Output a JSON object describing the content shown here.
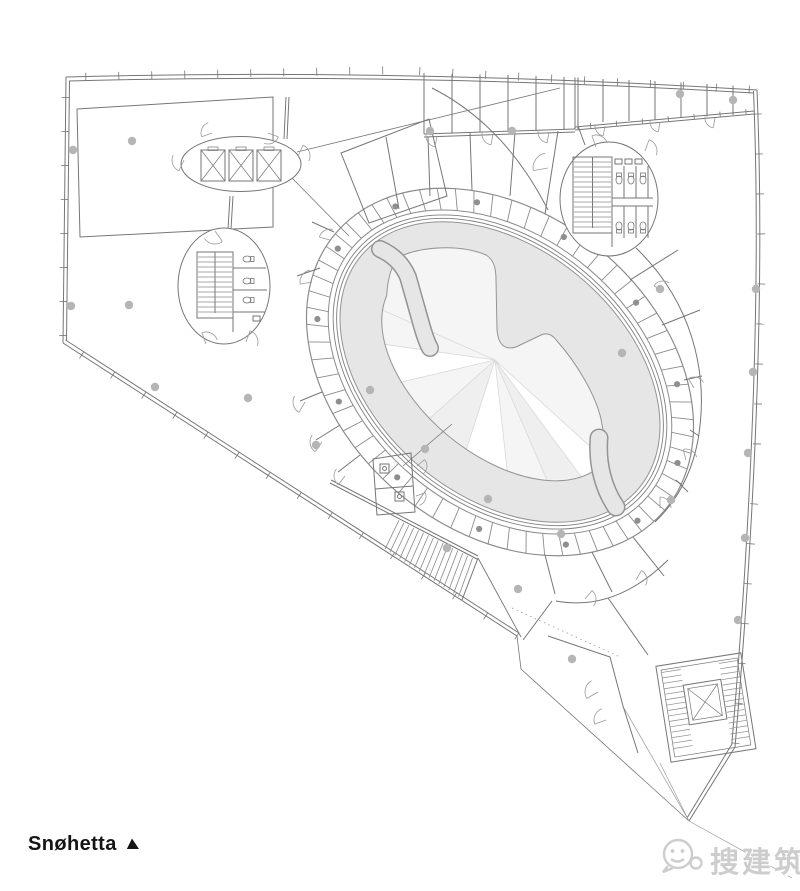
{
  "branding": {
    "logo_text": "Snøhetta"
  },
  "watermark": {
    "text": "搜建筑"
  },
  "colors": {
    "line": "#767676",
    "line_light": "#9a9a9a",
    "fin": "#8c8c8c",
    "ramp_fill": "#e6e6e6",
    "ramp_edge": "#949494",
    "void_fill": "#f5f5f5",
    "wedge_fill": "#efefef",
    "fan_line": "#d9d9d9",
    "column_fill": "#b5b5b5",
    "logo_color": "#151515",
    "watermark_color": "#cdcdcd",
    "watermark_highlight": "#ffffff"
  }
}
